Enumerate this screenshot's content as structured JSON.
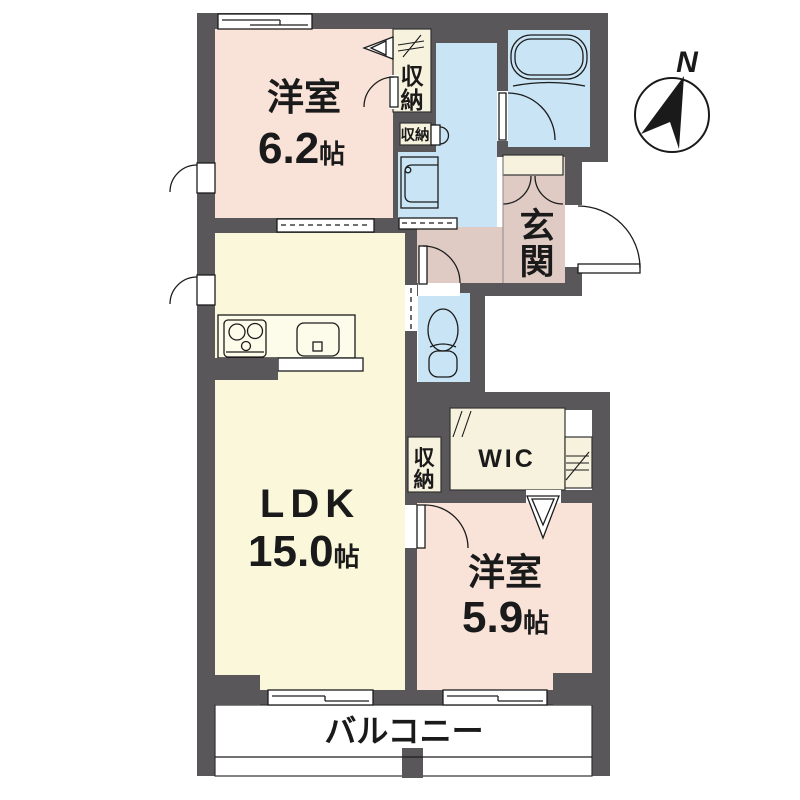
{
  "compass": {
    "label": "N"
  },
  "colors": {
    "wall": "#595759",
    "bedroom": "#f9e3d8",
    "ldk": "#faf7da",
    "wet_area": "#c9e4f5",
    "hall": "#dfcbc4",
    "closet": "#f6f2dd",
    "counter": "#fdfbea",
    "white": "#ffffff"
  },
  "rooms": {
    "bedroom1": {
      "name": "洋室",
      "size": "6.2",
      "unit": "帖"
    },
    "ldk": {
      "name": "LDK",
      "size": "15.0",
      "unit": "帖"
    },
    "bedroom2": {
      "name": "洋室",
      "size": "5.9",
      "unit": "帖"
    },
    "entrance": {
      "char1": "玄",
      "char2": "関"
    },
    "balcony": {
      "name": "バルコニー"
    },
    "wic": {
      "name": "WIC"
    },
    "closet_bedroom": {
      "char1": "収",
      "char2": "納"
    },
    "closet_hall": {
      "name": "収納"
    },
    "closet_ldk": {
      "char1": "収",
      "char2": "納"
    }
  }
}
